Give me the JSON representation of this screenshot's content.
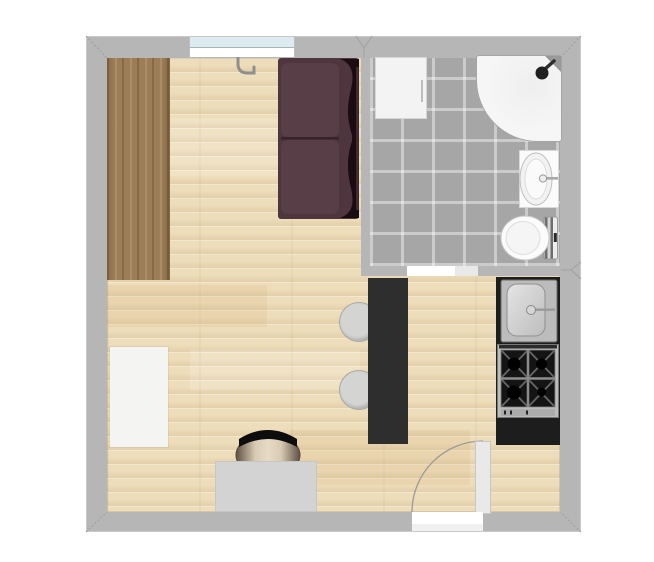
{
  "view": {
    "name": "apartment-floor-plan",
    "background": "#ffffff"
  },
  "colors": {
    "wall": "#b6b6b6",
    "wallEdge": "#c9c9c9",
    "jointLine": "#a0a0a0",
    "parquet": "#eeddba",
    "tile": "#a6a6a6",
    "grout": "#bdbdbd",
    "counter": "#1d1d1d",
    "partition": "#2e2e2e",
    "sofaBody": "#4e353e",
    "sofaCushion": "#583e47",
    "sofaShadow": "#1a0c12",
    "sofaHighlight": "#6b4d57",
    "wardrobe": "#9c7d55",
    "rug": "#f4f4f2",
    "desk": "#d3d3d3",
    "stool": "#d4d4d2",
    "fixtureWhite": "#fbfbfb",
    "fixtureEdge": "#c6c6c6",
    "steel": "#bcbcbc",
    "stoveBlack": "#141414",
    "glass": "#dcebf0",
    "doorLeaf": "#e9e9e9",
    "swingArc": "#9b9b9b",
    "washer": "#f3f3f3",
    "showerTray": "#f6f6f6",
    "chairSeatDark": "#6a5c4e",
    "chairSeatLight": "#e6dbc6",
    "chairBack": "#0d0d0d"
  },
  "rooms": [
    {
      "id": "living-room",
      "floor": "light-parquet"
    },
    {
      "id": "bathroom",
      "floor": "gray-tile"
    }
  ],
  "furniture": [
    {
      "id": "wardrobe",
      "room": "living-room"
    },
    {
      "id": "sofa",
      "room": "living-room"
    },
    {
      "id": "wall-hook",
      "room": "living-room"
    },
    {
      "id": "area-rug",
      "room": "living-room"
    },
    {
      "id": "desk",
      "room": "living-room"
    },
    {
      "id": "office-chair",
      "room": "living-room"
    },
    {
      "id": "stool-1",
      "room": "living-room"
    },
    {
      "id": "stool-2",
      "room": "living-room"
    },
    {
      "id": "partition-wall",
      "room": "living-room"
    },
    {
      "id": "kitchen-counter",
      "room": "living-room"
    },
    {
      "id": "kitchen-sink",
      "room": "living-room"
    },
    {
      "id": "gas-stove",
      "room": "living-room"
    },
    {
      "id": "washing-machine",
      "room": "bathroom"
    },
    {
      "id": "corner-shower",
      "room": "bathroom"
    },
    {
      "id": "bathroom-sink",
      "room": "bathroom"
    },
    {
      "id": "toilet",
      "room": "bathroom"
    },
    {
      "id": "window",
      "room": "living-room"
    },
    {
      "id": "bathroom-door",
      "room": "bathroom"
    },
    {
      "id": "entry-door",
      "room": "living-room"
    }
  ]
}
